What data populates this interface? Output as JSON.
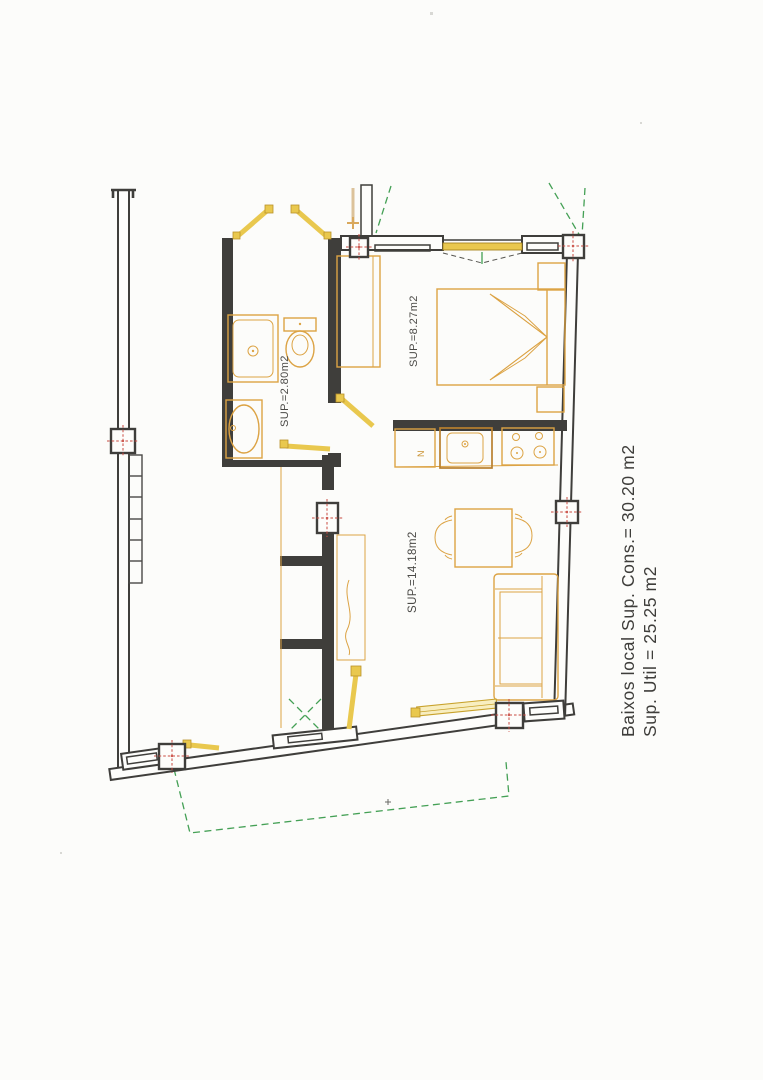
{
  "document": {
    "kind": "scanned floor plan",
    "floor": "Baixos"
  },
  "annotation": {
    "line1": "Baixos local Sup. Cons.= 30.20 m2",
    "line2": "Sup. Util = 25.25 m2"
  },
  "rooms": {
    "bathroom": {
      "label": "SUP.=2.80m2",
      "area_m2": 2.8
    },
    "bedroom": {
      "label": "SUP.=8.27m2",
      "area_m2": 8.27
    },
    "living": {
      "label": "SUP.=14.18m2",
      "area_m2": 14.18
    }
  },
  "totals": {
    "sup_construida_m2": 30.2,
    "sup_util_m2": 25.25
  },
  "kitchen": {
    "fridge_label": "N"
  },
  "colors": {
    "wall": "#3f3e3b",
    "furniture": "#dca344",
    "door": "#e9c84e",
    "boundary_green": "#44a055",
    "axis_red": "#c94b42",
    "text": "#3e3d3a",
    "paper": "#fcfcfa"
  }
}
